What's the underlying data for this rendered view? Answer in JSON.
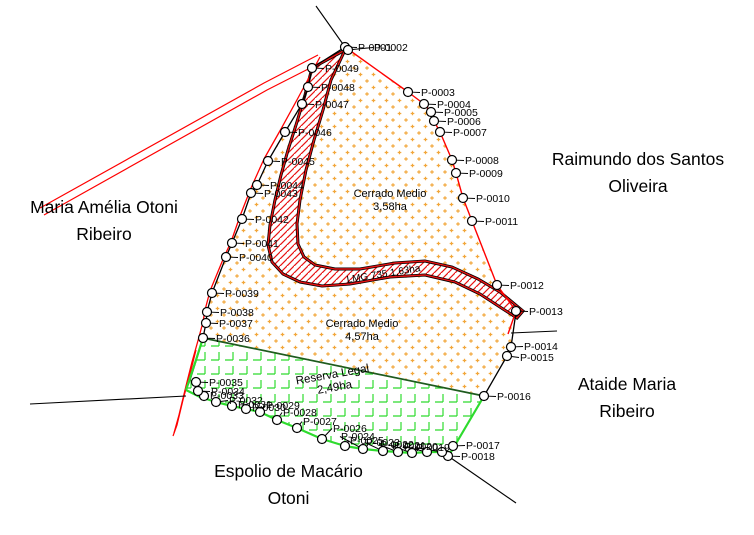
{
  "neighbors": [
    {
      "id": "maria-amelia-otoni-ribeiro",
      "lines": [
        "Maria Amélia Otoni",
        "Ribeiro"
      ]
    },
    {
      "id": "raimundo-dos-santos-oliveira",
      "lines": [
        "Raimundo dos Santos",
        "Oliveira"
      ]
    },
    {
      "id": "ataide-maria-ribeiro",
      "lines": [
        "Ataide Maria",
        "Ribeiro"
      ]
    },
    {
      "id": "espolio-de-macario-otoni",
      "lines": [
        "Espolio de Macário",
        "Otoni"
      ]
    }
  ],
  "areas": [
    {
      "name": "cerrado-medio-north-label",
      "lines": [
        "Cerrado Medio",
        "3,58ha"
      ],
      "x": 390,
      "y": 197,
      "rotation": 0,
      "font_size": 11
    },
    {
      "name": "cerrado-medio-south-label",
      "lines": [
        "Cerrado Medio",
        "4,57ha"
      ],
      "x": 362,
      "y": 327,
      "rotation": 0,
      "font_size": 11
    },
    {
      "name": "reserva-legal-label",
      "lines": [
        "Reserva Legal",
        "2,49ha"
      ],
      "x": 333,
      "y": 378,
      "rotation": -10,
      "font_size": 11.5
    },
    {
      "name": "road-lmg-735-label",
      "lines": [
        "LMG 735 1,63ha"
      ],
      "x": 384,
      "y": 277,
      "rotation": -9,
      "font_size": 10
    }
  ],
  "points": [
    {
      "id": "P-0001",
      "x": 345,
      "y": 47,
      "tx": 358,
      "ty": 51
    },
    {
      "id": "P-0002",
      "x": 348,
      "y": 50,
      "tx": 374,
      "ty": 51
    },
    {
      "id": "P-0003",
      "x": 408,
      "y": 92,
      "tx": 421,
      "ty": 96
    },
    {
      "id": "P-0004",
      "x": 424,
      "y": 104,
      "tx": 437,
      "ty": 108
    },
    {
      "id": "P-0005",
      "x": 431,
      "y": 112,
      "tx": 444,
      "ty": 116
    },
    {
      "id": "P-0006",
      "x": 434,
      "y": 121,
      "tx": 447,
      "ty": 125
    },
    {
      "id": "P-0007",
      "x": 440,
      "y": 132,
      "tx": 453,
      "ty": 136
    },
    {
      "id": "P-0008",
      "x": 452,
      "y": 160,
      "tx": 465,
      "ty": 164
    },
    {
      "id": "P-0009",
      "x": 456,
      "y": 173,
      "tx": 469,
      "ty": 177
    },
    {
      "id": "P-0010",
      "x": 463,
      "y": 198,
      "tx": 476,
      "ty": 202
    },
    {
      "id": "P-0011",
      "x": 472,
      "y": 221,
      "tx": 485,
      "ty": 225
    },
    {
      "id": "P-0012",
      "x": 497,
      "y": 285,
      "tx": 510,
      "ty": 289
    },
    {
      "id": "P-0013",
      "x": 516,
      "y": 311,
      "tx": 529,
      "ty": 315
    },
    {
      "id": "P-0014",
      "x": 511,
      "y": 347,
      "tx": 524,
      "ty": 350
    },
    {
      "id": "P-0015",
      "x": 507,
      "y": 356,
      "tx": 520,
      "ty": 361
    },
    {
      "id": "P-0016",
      "x": 484,
      "y": 396,
      "tx": 497,
      "ty": 400
    },
    {
      "id": "P-0017",
      "x": 453,
      "y": 446,
      "tx": 466,
      "ty": 449
    },
    {
      "id": "P-0018",
      "x": 448,
      "y": 456,
      "tx": 461,
      "ty": 460
    },
    {
      "id": "P-0019",
      "x": 442,
      "y": 452,
      "tx": 416,
      "ty": 451
    },
    {
      "id": "P-0020",
      "x": 427,
      "y": 452,
      "tx": 404,
      "ty": 450
    },
    {
      "id": "P-0021",
      "x": 412,
      "y": 453,
      "tx": 392,
      "ty": 449
    },
    {
      "id": "P-0022",
      "x": 398,
      "y": 452,
      "tx": 380,
      "ty": 448
    },
    {
      "id": "P-0023",
      "x": 383,
      "y": 451,
      "tx": 366,
      "ty": 446
    },
    {
      "id": "P-0024",
      "x": 363,
      "y": 449,
      "tx": 341,
      "ty": 440
    },
    {
      "id": "P-0025",
      "x": 345,
      "y": 446,
      "tx": 350,
      "ty": 444
    },
    {
      "id": "P-0026",
      "x": 322,
      "y": 439,
      "tx": 333,
      "ty": 432
    },
    {
      "id": "P-0027",
      "x": 297,
      "y": 428,
      "tx": 303,
      "ty": 425
    },
    {
      "id": "P-0028",
      "x": 277,
      "y": 420,
      "tx": 283,
      "ty": 416
    },
    {
      "id": "P-0029",
      "x": 260,
      "y": 412,
      "tx": 266,
      "ty": 409
    },
    {
      "id": "P-0030",
      "x": 246,
      "y": 409,
      "tx": 252,
      "ty": 411
    },
    {
      "id": "P-0031",
      "x": 232,
      "y": 406,
      "tx": 238,
      "ty": 408
    },
    {
      "id": "P-0032",
      "x": 216,
      "y": 402,
      "tx": 229,
      "ty": 404
    },
    {
      "id": "P-0033",
      "x": 204,
      "y": 396,
      "tx": 210,
      "ty": 399
    },
    {
      "id": "P-0034",
      "x": 198,
      "y": 391,
      "tx": 211,
      "ty": 395
    },
    {
      "id": "P-0035",
      "x": 196,
      "y": 382,
      "tx": 209,
      "ty": 386
    },
    {
      "id": "P-0036",
      "x": 203,
      "y": 338,
      "tx": 216,
      "ty": 342
    },
    {
      "id": "P-0037",
      "x": 206,
      "y": 323,
      "tx": 219,
      "ty": 327
    },
    {
      "id": "P-0038",
      "x": 207,
      "y": 312,
      "tx": 220,
      "ty": 316
    },
    {
      "id": "P-0039",
      "x": 212,
      "y": 293,
      "tx": 225,
      "ty": 297
    },
    {
      "id": "P-0040",
      "x": 226,
      "y": 257,
      "tx": 239,
      "ty": 261
    },
    {
      "id": "P-0041",
      "x": 232,
      "y": 243,
      "tx": 245,
      "ty": 247
    },
    {
      "id": "P-0042",
      "x": 242,
      "y": 219,
      "tx": 255,
      "ty": 223
    },
    {
      "id": "P-0043",
      "x": 251,
      "y": 193,
      "tx": 264,
      "ty": 197
    },
    {
      "id": "P-0044",
      "x": 257,
      "y": 185,
      "tx": 270,
      "ty": 189
    },
    {
      "id": "P-0045",
      "x": 268,
      "y": 161,
      "tx": 281,
      "ty": 165
    },
    {
      "id": "P-0046",
      "x": 285,
      "y": 132,
      "tx": 298,
      "ty": 136
    },
    {
      "id": "P-0047",
      "x": 302,
      "y": 104,
      "tx": 315,
      "ty": 108
    },
    {
      "id": "P-0048",
      "x": 308,
      "y": 87,
      "tx": 321,
      "ty": 91
    },
    {
      "id": "P-0049",
      "x": 312,
      "y": 68,
      "tx": 325,
      "ty": 72
    }
  ],
  "colors": {
    "boundary_red": "#FF0000",
    "road_hatch_red": "#E81313",
    "reserve_green": "#2EDB2E",
    "reserve_edge_dark_green": "#1E5B1E",
    "parcel_dot_orange": "#F2A73B",
    "line_black": "#000000",
    "background": "#FFFFFF"
  }
}
